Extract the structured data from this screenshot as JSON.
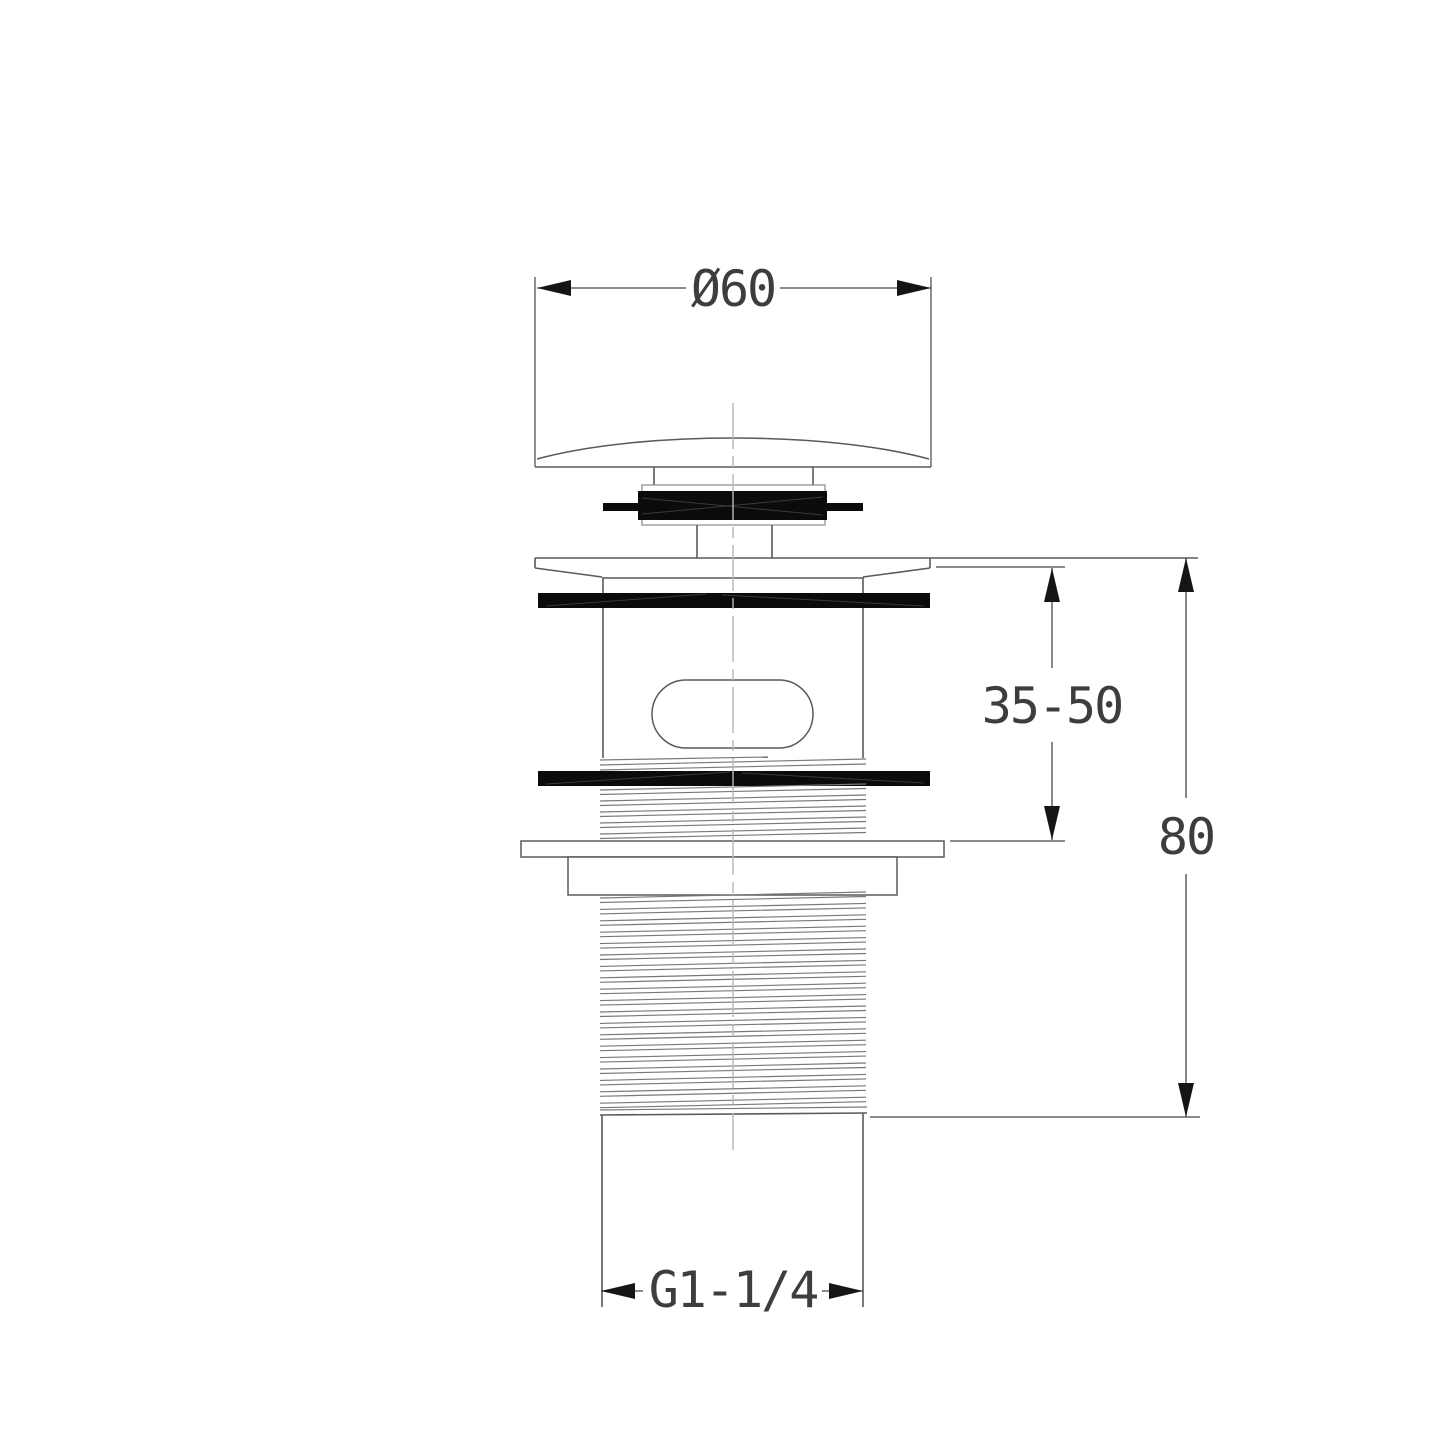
{
  "drawing": {
    "type": "technical-section-drawing",
    "subject": "basin pop-up waste drain fitting, front section view",
    "dimensions": {
      "diameter_top": "Ø60",
      "clamp_range": "35-50",
      "overall_height": "80",
      "thread": "G1-1/4"
    },
    "colors": {
      "background": "#ffffff",
      "object_line": "#5a5a5a",
      "dimension_line": "#474747",
      "solid_fill": "#0b0b0b",
      "centerline": "#b3b8bb",
      "text": "#3d3d3d"
    }
  }
}
